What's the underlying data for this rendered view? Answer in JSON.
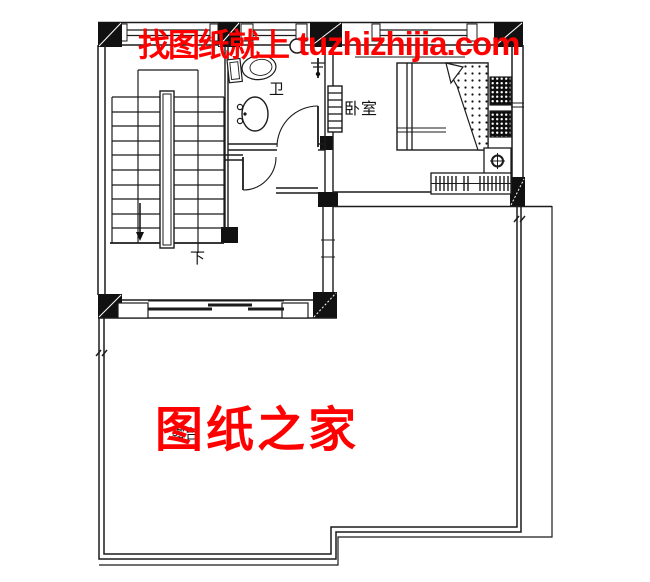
{
  "watermarks": {
    "top": {
      "text_cn": "找图纸就上",
      "text_latin": "tuzhizhijia.com",
      "color": "#ff0000"
    },
    "center": {
      "text": "图纸之家",
      "color": "#ff0000"
    }
  },
  "room_labels": {
    "bathroom": "卫",
    "bedroom": "卧室",
    "stair_direction": "下",
    "terrace": "露台"
  },
  "colors": {
    "line": "#1b1b1b",
    "background": "#ffffff",
    "watermark_red": "#ff0000"
  }
}
